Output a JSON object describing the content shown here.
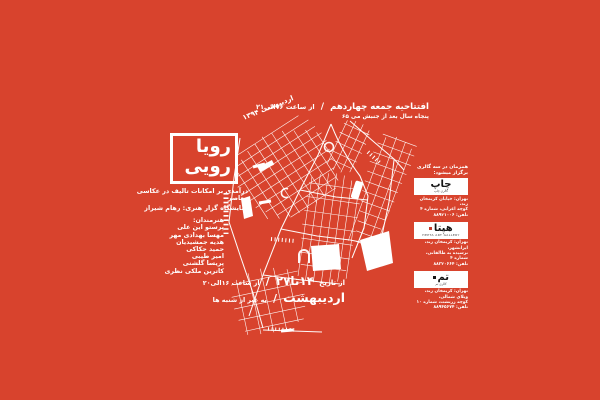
{
  "poster": {
    "colors": {
      "background": "#d8432d",
      "map_lines": "#ffffff",
      "logo_text": "#161616"
    },
    "title": {
      "line1": "رویا",
      "line2": "رویی"
    },
    "opening": {
      "line1_main": "افتتاحیه جمعه چهاردهم",
      "sep": "/",
      "line1_time": "از ساعت ۱۶الی۲۱",
      "line2": "پنجاه سال بعد از جنبش می ۶۵",
      "rotated_date": "اردیبهشت ۱۳۹۴"
    },
    "about": {
      "line1": "درآمدی بر امکانات تالیف در عکاسی معاصر",
      "line2": "نمایشگاه گزار هنری: رهام شیراز",
      "artists_label": "هنرمندان:",
      "artists": [
        "پرستو این علی",
        "مهسا بهدادی مهر",
        "هدیه جمشیدیان",
        "حمید حکاکی",
        "امیر طیبی",
        "پریسا گلشنی",
        "کاترین ملکی نظری"
      ]
    },
    "duration": {
      "prefix": "از تاریخ",
      "dates": "۱۴تا۲۷",
      "sep": "/",
      "hours": "از ساعت ۱۶الی۲۰",
      "month": "اردیبهشت",
      "note": "به غیر از شنبه ها"
    },
    "galleries": {
      "header": "همزمان در سه گالری برگزار میشود:",
      "items": [
        {
          "logo": "چاپ",
          "tagline": "گالری چاپ",
          "address": [
            "تهران: خیابان کریمخان زند،",
            "کوچه اعرابی، شماره ۴",
            "تلفن: ۸۸۹۲۱۰۰۶"
          ]
        },
        {
          "logo": "هپتا",
          "tagline": "HEPTA ART GALLERY",
          "address": [
            "تهران: کریمخان زند، ایرانشهر،",
            "نرسیده به طالقانی، شماره ۴",
            "تلفن: ۸۸۳۲۰۶۶۴"
          ]
        },
        {
          "logo": "تم",
          "tagline": "گالری تم",
          "address": [
            "تهران: کریمخان زند، ویلای شمالی،",
            "کوچه زرتشت، شماره ۱۰",
            "تلفن: ۸۸۹۴۵۶۷۴"
          ]
        }
      ]
    }
  }
}
